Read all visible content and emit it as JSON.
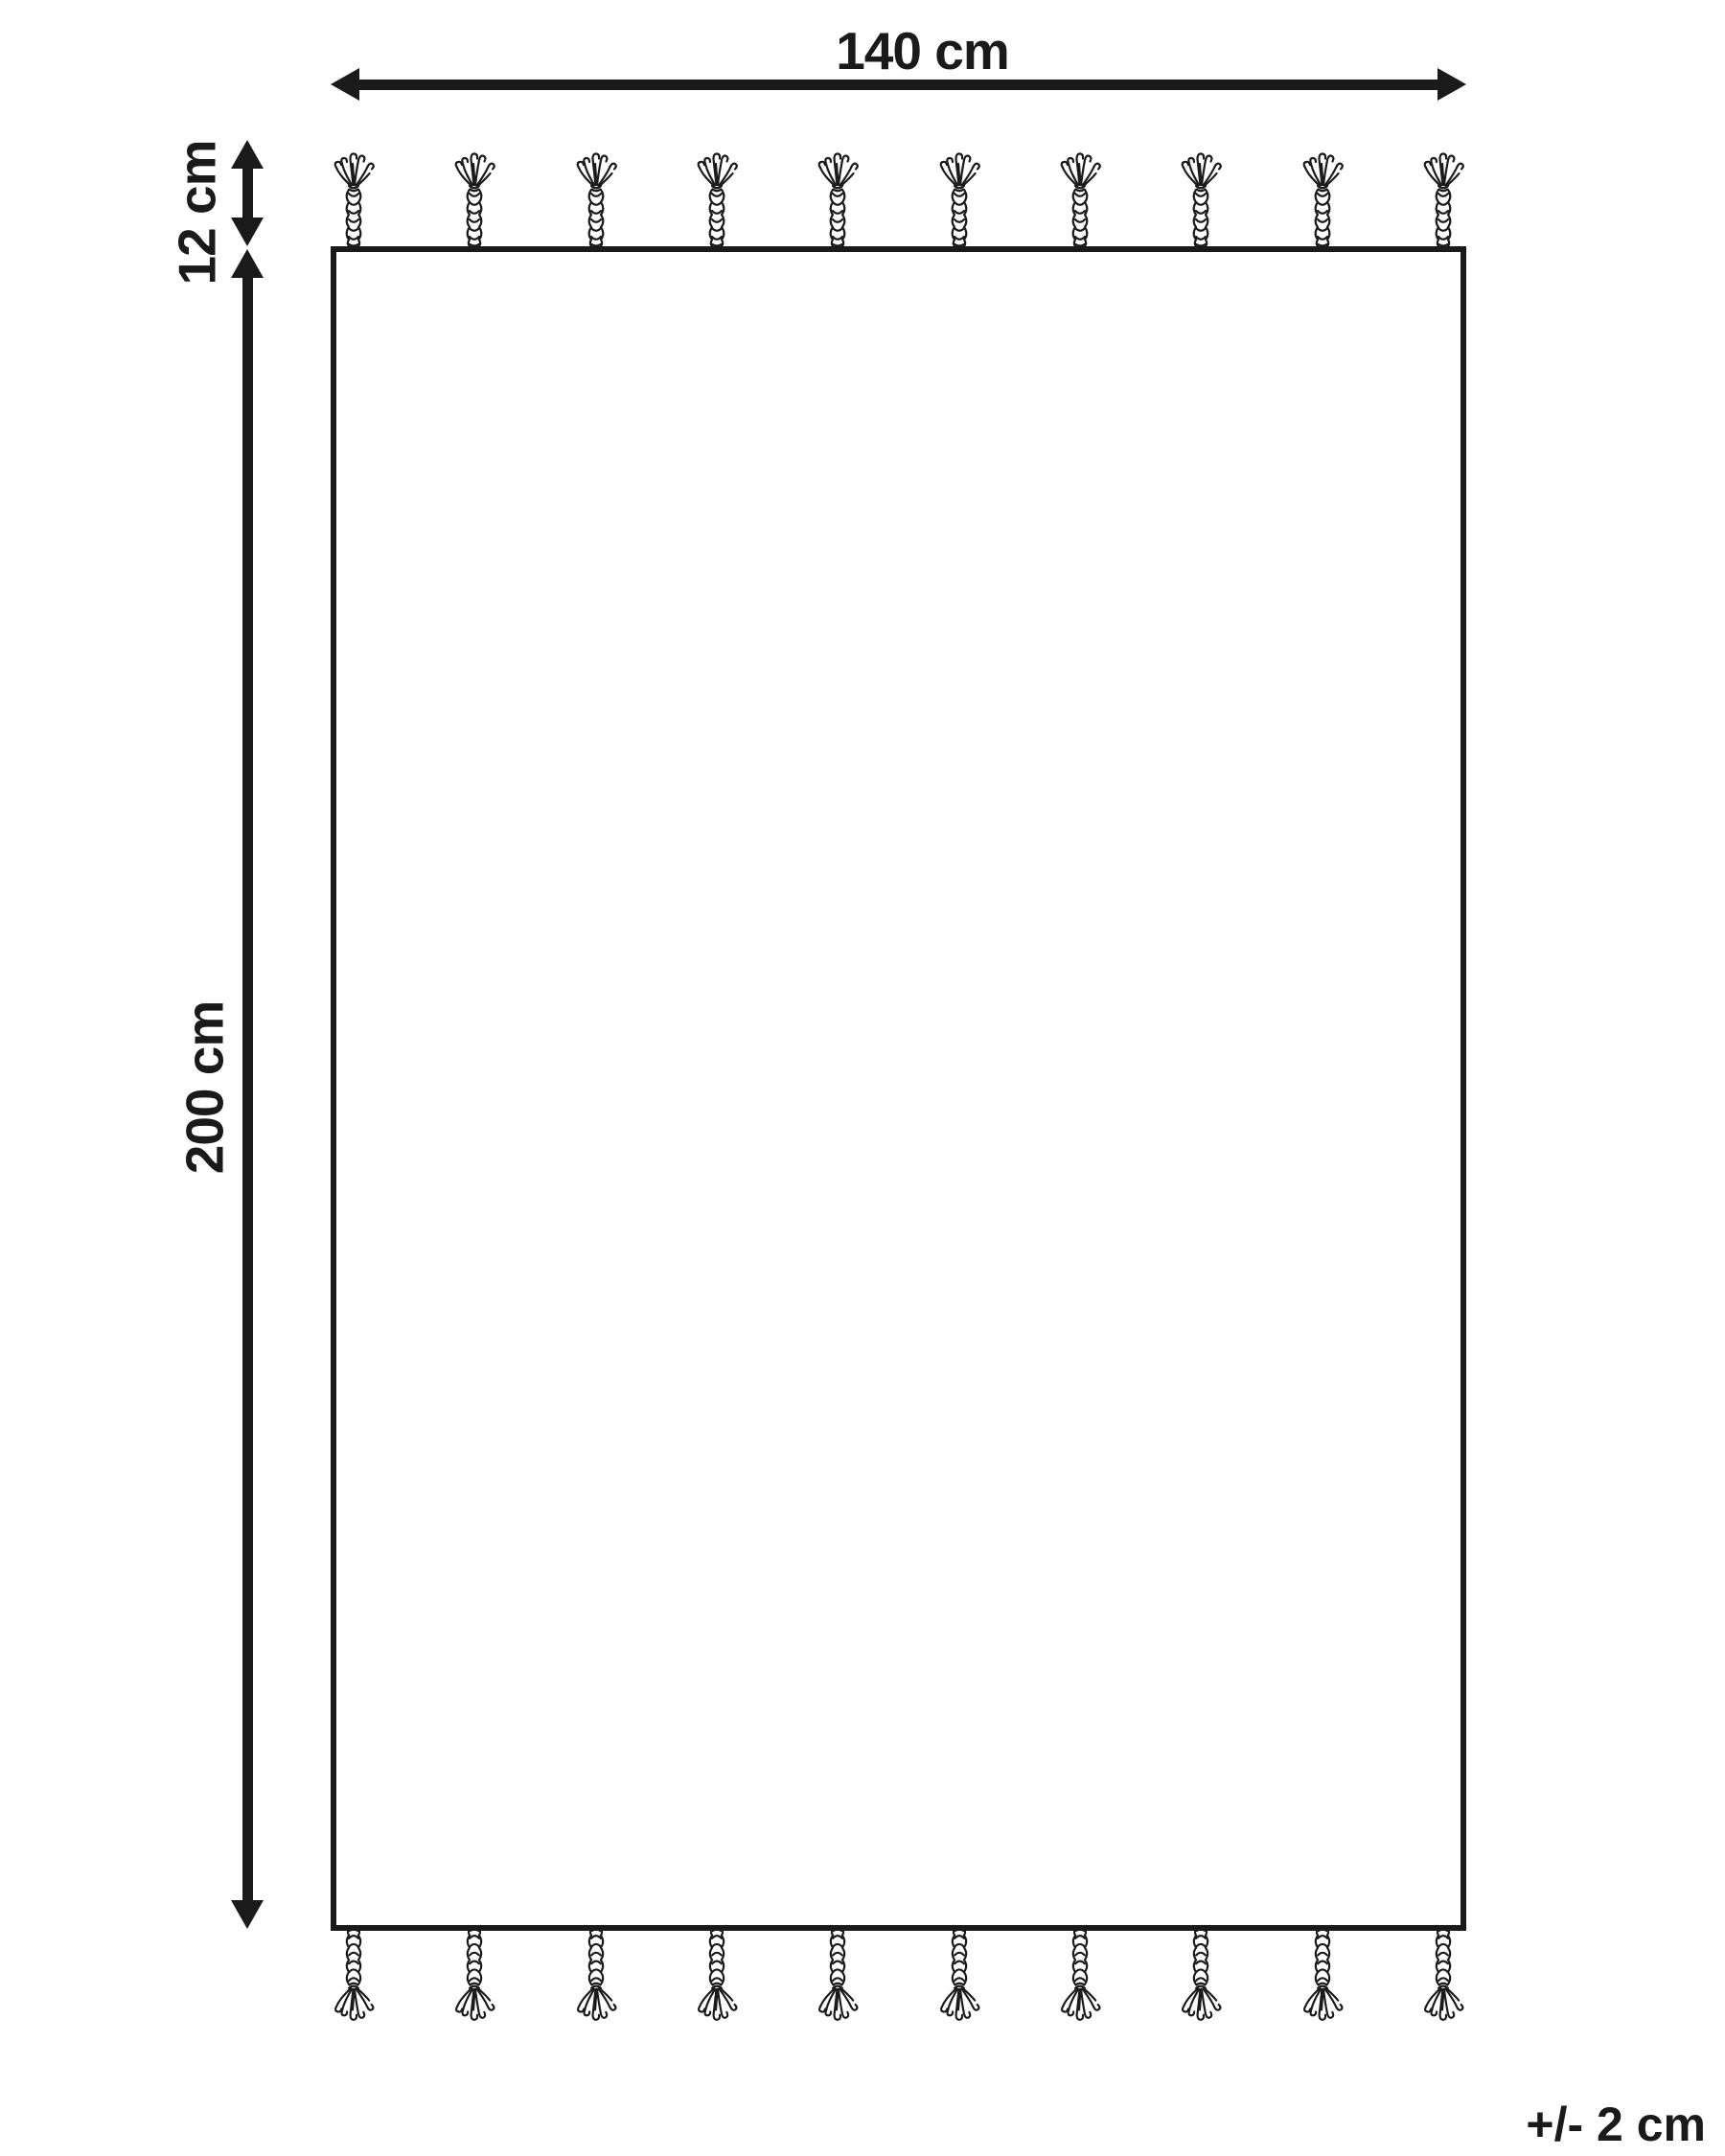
{
  "diagram": {
    "kind": "rug-dimension-diagram",
    "width_label": "140 cm",
    "height_label": "200 cm",
    "tassel_length_label": "12 cm",
    "tolerance_label": "+/- 2 cm",
    "tassels_per_side": 10,
    "tassel_sides": [
      "top",
      "bottom"
    ],
    "ink_color": "#1a1a1a",
    "background_color": "#ffffff"
  }
}
